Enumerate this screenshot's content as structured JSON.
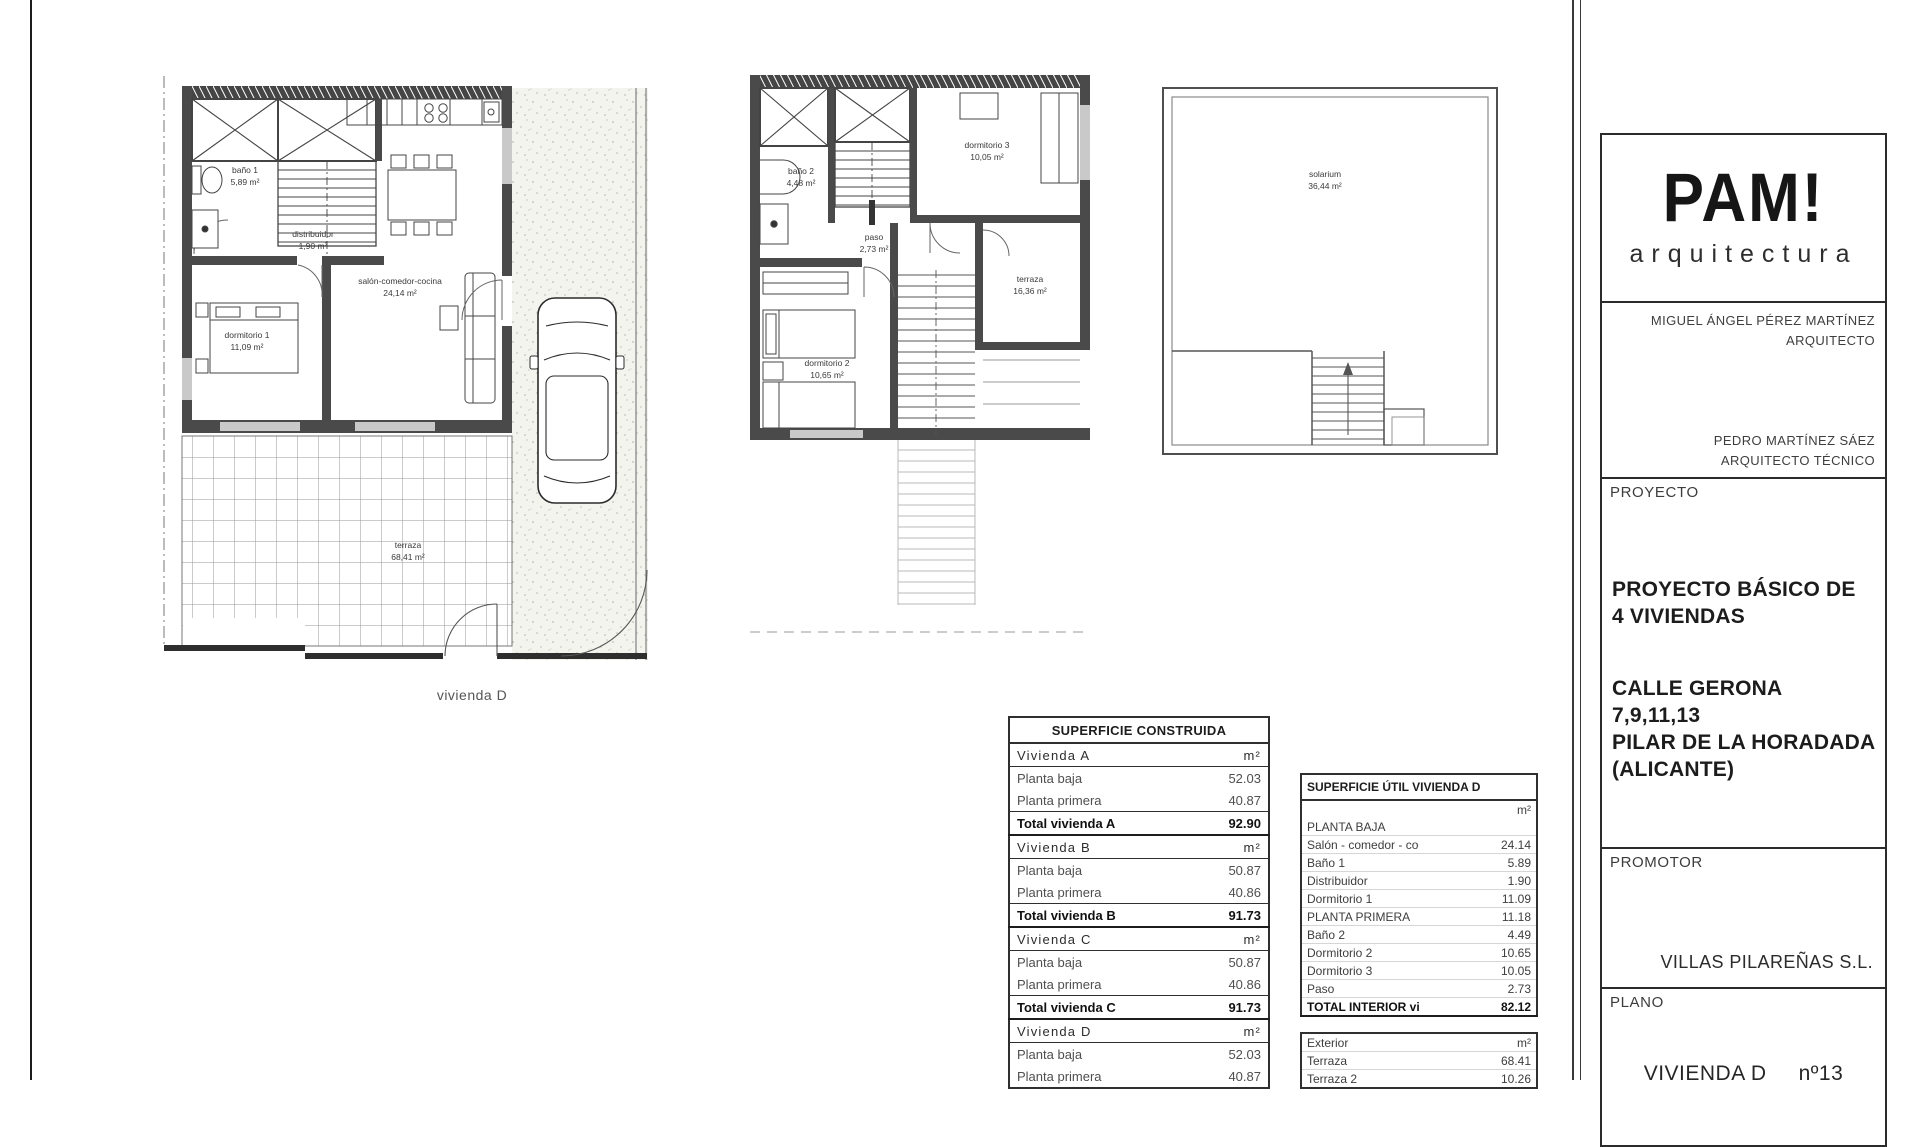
{
  "plans": {
    "planta_baja": {
      "bano1_name": "baño 1",
      "bano1_area": "5,89 m²",
      "distribuidor_name": "distribuidor",
      "distribuidor_area": "1,90 m²",
      "salon_name": "salón-comedor-cocina",
      "salon_area": "24,14 m²",
      "dormitorio1_name": "dormitorio 1",
      "dormitorio1_area": "11,09 m²",
      "terraza_name": "terraza",
      "terraza_area": "68,41 m²",
      "caption": "vivienda D"
    },
    "planta_primera": {
      "bano2_name": "baño 2",
      "bano2_area": "4,48 m²",
      "paso_name": "paso",
      "paso_area": "2,73 m²",
      "dormitorio3_name": "dormitorio 3",
      "dormitorio3_area": "10,05 m²",
      "dormitorio2_name": "dormitorio 2",
      "dormitorio2_area": "10,65 m²",
      "terraza_name": "terraza",
      "terraza_area": "16,36 m²"
    },
    "solarium": {
      "name": "solarium",
      "area": "36,44 m²"
    }
  },
  "construida": {
    "title": "SUPERFICIE CONSTRUIDA",
    "unit": "m²",
    "a": {
      "header": "Vivienda A",
      "row1_label": "Planta baja",
      "row1_value": "52.03",
      "row2_label": "Planta primera",
      "row2_value": "40.87",
      "total_label": "Total vivienda A",
      "total_value": "92.90"
    },
    "b": {
      "header": "Vivienda B",
      "row1_label": "Planta baja",
      "row1_value": "50.87",
      "row2_label": "Planta primera",
      "row2_value": "40.86",
      "total_label": "Total vivienda B",
      "total_value": "91.73"
    },
    "c": {
      "header": "Vivienda C",
      "row1_label": "Planta baja",
      "row1_value": "50.87",
      "row2_label": "Planta primera",
      "row2_value": "40.86",
      "total_label": "Total vivienda C",
      "total_value": "91.73"
    },
    "d": {
      "header": "Vivienda D",
      "row1_label": "Planta baja",
      "row1_value": "52.03",
      "row2_label": "Planta primera",
      "row2_value": "40.87"
    }
  },
  "util": {
    "title": "SUPERFICIE ÚTIL VIVIENDA D",
    "unit": "m²",
    "rows": [
      {
        "label": "PLANTA BAJA",
        "value": ""
      },
      {
        "label": "Salón - comedor - cocina",
        "value": "24.14"
      },
      {
        "label": "Baño 1",
        "value": "5.89"
      },
      {
        "label": "Distribuidor",
        "value": "1.90"
      },
      {
        "label": "Dormitorio 1",
        "value": "11.09"
      },
      {
        "label": "PLANTA PRIMERA",
        "value": "11.18"
      },
      {
        "label": "Baño 2",
        "value": "4.49"
      },
      {
        "label": "Dormitorio 2",
        "value": "10.65"
      },
      {
        "label": "Dormitorio 3",
        "value": "10.05"
      },
      {
        "label": "Paso",
        "value": "2.73"
      }
    ],
    "total_label": "TOTAL INTERIOR vivienda",
    "total_value": "82.12",
    "exterior_label": "Exterior",
    "exterior_unit": "m²",
    "exterior_rows": [
      {
        "label": "Terraza",
        "value": "68.41"
      },
      {
        "label": "Terraza 2",
        "value": "10.26"
      }
    ]
  },
  "title_block": {
    "logo_main": "PAM!",
    "logo_sub": "arquitectura",
    "architect_name": "MIGUEL ÁNGEL PÉREZ MARTÍNEZ",
    "architect_role": "ARQUITECTO",
    "technical_name": "PEDRO MARTÍNEZ SÁEZ",
    "technical_role": "ARQUITECTO TÉCNICO",
    "proyecto_label": "PROYECTO",
    "proyecto_line1": "PROYECTO BÁSICO DE",
    "proyecto_line2": "4 VIVIENDAS",
    "address_line1": "CALLE GERONA",
    "address_line2": "7,9,11,13",
    "address_line3": "PILAR DE LA HORADADA",
    "address_line4": "(ALICANTE)",
    "promotor_label": "PROMOTOR",
    "promotor_name": "VILLAS PILAREÑAS S.L.",
    "plano_label": "PLANO",
    "plano_name": "VIVIENDA D",
    "plano_number": "nº13"
  }
}
